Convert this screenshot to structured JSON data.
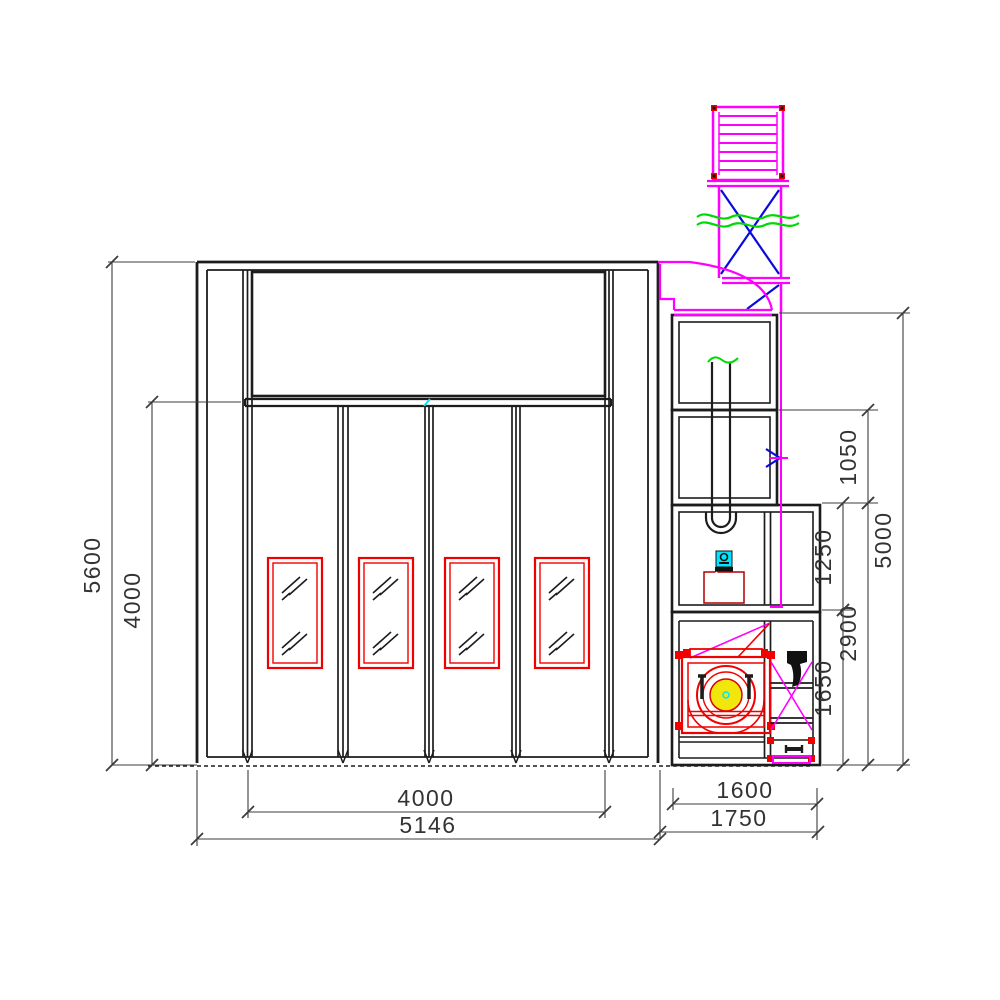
{
  "meta": {
    "kind": "CAD side-elevation drawing of a vehicle spray booth with four folding doors, mechanical room with heat-exchanger pipe, burner, centrifugal fan and roof exhaust duct"
  },
  "colors": {
    "line": "#1c1c1c",
    "dim": "#3c3c3c",
    "red": "#f20000",
    "green": "#00d900",
    "magenta": "#ff00ff",
    "blue": "#0a0adc",
    "cyan": "#00e5ff",
    "yellow": "#f2e70c",
    "hatch": "#4a4a4a",
    "bg": "#ffffff"
  },
  "dims": {
    "booth_height": "5600",
    "door_opening_height": "4000",
    "door_opening_width": "4000",
    "booth_width": "5146",
    "duct_section_height": "1050",
    "mech_total_height": "5000",
    "burner_section_height": "1250",
    "lower_section_height": "2900",
    "fan_section_height": "1650",
    "fan_room_width": "1600",
    "mech_room_width": "1750"
  }
}
